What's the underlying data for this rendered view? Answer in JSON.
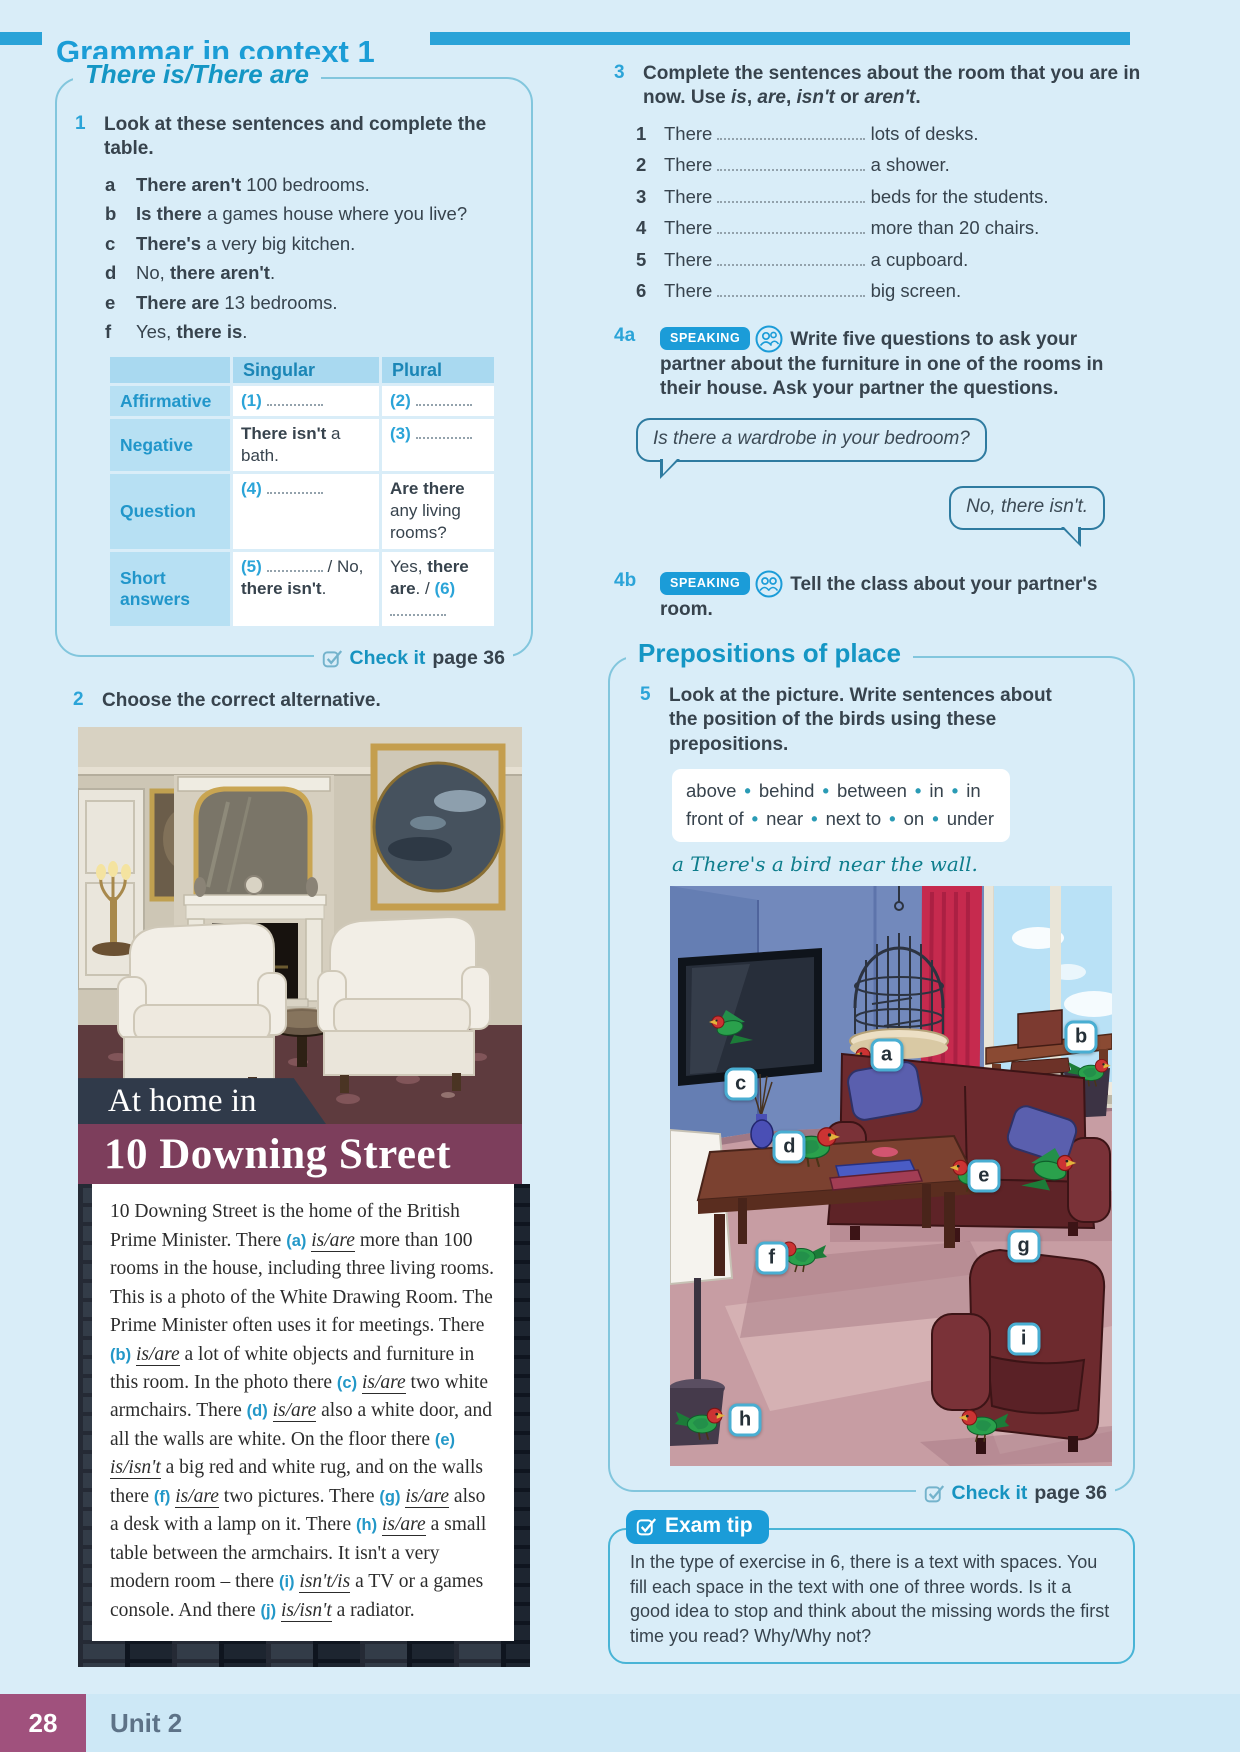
{
  "header": {
    "title": "Grammar in context 1"
  },
  "footer": {
    "page_number": "28",
    "unit": "Unit 2"
  },
  "colors": {
    "accent_blue": "#1b9cd8",
    "teal": "#1496c4",
    "plum": "#7d3e5c",
    "dark_text": "#37434e",
    "page_bg": "#d9edf8"
  },
  "section_there": {
    "title": "There is/There are",
    "ex1": {
      "number": "1",
      "prompt": "Look at these sentences and complete the table.",
      "items": [
        {
          "letter": "a",
          "parts": [
            {
              "b": "There aren't"
            },
            {
              "t": " 100 bedrooms."
            }
          ]
        },
        {
          "letter": "b",
          "parts": [
            {
              "b": "Is there"
            },
            {
              "t": " a games house where you live?"
            }
          ]
        },
        {
          "letter": "c",
          "parts": [
            {
              "b": "There's"
            },
            {
              "t": " a very big kitchen."
            }
          ]
        },
        {
          "letter": "d",
          "parts": [
            {
              "t": "No, "
            },
            {
              "b": "there aren't"
            },
            {
              "t": "."
            }
          ]
        },
        {
          "letter": "e",
          "parts": [
            {
              "b": "There are"
            },
            {
              "t": " 13 bedrooms."
            }
          ]
        },
        {
          "letter": "f",
          "parts": [
            {
              "t": "Yes, "
            },
            {
              "b": "there is"
            },
            {
              "t": "."
            }
          ]
        }
      ]
    },
    "table": {
      "headers": [
        "",
        "Singular",
        "Plural"
      ],
      "rows": [
        {
          "label": "Affirmative",
          "cells": [
            [
              {
                "blank": "(1)"
              }
            ],
            [
              {
                "blank": "(2)"
              }
            ]
          ]
        },
        {
          "label": "Negative",
          "cells": [
            [
              {
                "b": "There isn't"
              },
              {
                "t": " a bath."
              }
            ],
            [
              {
                "blank": "(3)"
              }
            ]
          ]
        },
        {
          "label": "Question",
          "cells": [
            [
              {
                "blank": "(4)"
              }
            ],
            [
              {
                "b": "Are there"
              },
              {
                "t": " any living rooms?"
              }
            ]
          ]
        },
        {
          "label": "Short answers",
          "cells": [
            [
              {
                "blank": "(5)"
              },
              {
                "t": " / No, "
              },
              {
                "b": "there isn't"
              },
              {
                "t": "."
              }
            ],
            [
              {
                "t": "Yes, "
              },
              {
                "b": "there are"
              },
              {
                "t": ". / "
              },
              {
                "blank": "(6)"
              }
            ]
          ]
        }
      ]
    },
    "check_it": {
      "label": "Check it",
      "page": "page 36"
    }
  },
  "ex2": {
    "number": "2",
    "prompt": "Choose the correct alternative.",
    "banner_top": "At home in",
    "banner_main": "10 Downing Street",
    "passage": [
      {
        "t": "10 Downing Street is the home of the British Prime Minister. There "
      },
      {
        "m": "(a)",
        "c": "is/are"
      },
      {
        "t": " more than 100 rooms in the house, including three living rooms. This is a photo of the White Drawing Room. The Prime Minister often uses it for meetings. There "
      },
      {
        "m": "(b)",
        "c": "is/are"
      },
      {
        "t": " a lot of white objects and furniture in this room. In the photo there "
      },
      {
        "m": "(c)",
        "c": "is/are"
      },
      {
        "t": " two white armchairs. There "
      },
      {
        "m": "(d)",
        "c": "is/are"
      },
      {
        "t": " also a white door, and all the walls are white. On the floor there "
      },
      {
        "m": "(e)",
        "c": "is/isn't"
      },
      {
        "t": " a big red and white rug, and on the walls there "
      },
      {
        "m": "(f)",
        "c": "is/are"
      },
      {
        "t": " two pictures. There "
      },
      {
        "m": "(g)",
        "c": "is/are"
      },
      {
        "t": " also a desk with a lamp on it. There "
      },
      {
        "m": "(h)",
        "c": "is/are"
      },
      {
        "t": " a small table between the armchairs. It isn't a very modern room – there "
      },
      {
        "m": "(i)",
        "c": "isn't/is"
      },
      {
        "t": " a TV or a games console. And there "
      },
      {
        "m": "(j)",
        "c": "is/isn't"
      },
      {
        "t": " a radiator."
      }
    ]
  },
  "ex3": {
    "number": "3",
    "prompt_parts": [
      {
        "t": "Complete the sentences about the room that you are in now. Use "
      },
      {
        "i": "is"
      },
      {
        "t": ", "
      },
      {
        "i": "are"
      },
      {
        "t": ", "
      },
      {
        "i": "isn't"
      },
      {
        "t": " or "
      },
      {
        "i": "aren't"
      },
      {
        "t": "."
      }
    ],
    "items": [
      {
        "n": "1",
        "pre": "There",
        "post": "lots of desks."
      },
      {
        "n": "2",
        "pre": "There",
        "post": "a shower."
      },
      {
        "n": "3",
        "pre": "There",
        "post": "beds for the students."
      },
      {
        "n": "4",
        "pre": "There",
        "post": "more than 20 chairs."
      },
      {
        "n": "5",
        "pre": "There",
        "post": "a cupboard."
      },
      {
        "n": "6",
        "pre": "There",
        "post": "big screen."
      }
    ]
  },
  "ex4a": {
    "number": "4a",
    "badge": "SPEAKING",
    "text": "Write five questions to ask your partner about the furniture in one of the rooms in their house. Ask your partner the questions.",
    "bubble_question": "Is there a wardrobe in your bedroom?",
    "bubble_answer": "No, there isn't."
  },
  "ex4b": {
    "number": "4b",
    "badge": "SPEAKING",
    "text": "Tell the class about your partner's room."
  },
  "section_prepositions": {
    "title": "Prepositions of place",
    "ex5": {
      "number": "5",
      "prompt": "Look at the picture. Write sentences about the position of the birds using these prepositions."
    },
    "word_box": [
      "above",
      "behind",
      "between",
      "in",
      "in front of",
      "near",
      "next to",
      "on",
      "under"
    ],
    "example": "a There's a bird near the wall.",
    "picture_labels": [
      {
        "letter": "a",
        "x": 49,
        "y": 29
      },
      {
        "letter": "b",
        "x": 93,
        "y": 26
      },
      {
        "letter": "c",
        "x": 16,
        "y": 34
      },
      {
        "letter": "d",
        "x": 27,
        "y": 45
      },
      {
        "letter": "e",
        "x": 71,
        "y": 50
      },
      {
        "letter": "f",
        "x": 23,
        "y": 64
      },
      {
        "letter": "g",
        "x": 80,
        "y": 62
      },
      {
        "letter": "h",
        "x": 17,
        "y": 92
      },
      {
        "letter": "i",
        "x": 80,
        "y": 78
      }
    ],
    "check_it": {
      "label": "Check it",
      "page": "page 36"
    }
  },
  "exam_tip": {
    "title": "Exam tip",
    "text": "In the type of exercise in 6, there is a text with spaces. You fill each space in the text with one of three words. Is it a good idea to stop and think about the missing words the first time you read? Why/Why not?"
  }
}
